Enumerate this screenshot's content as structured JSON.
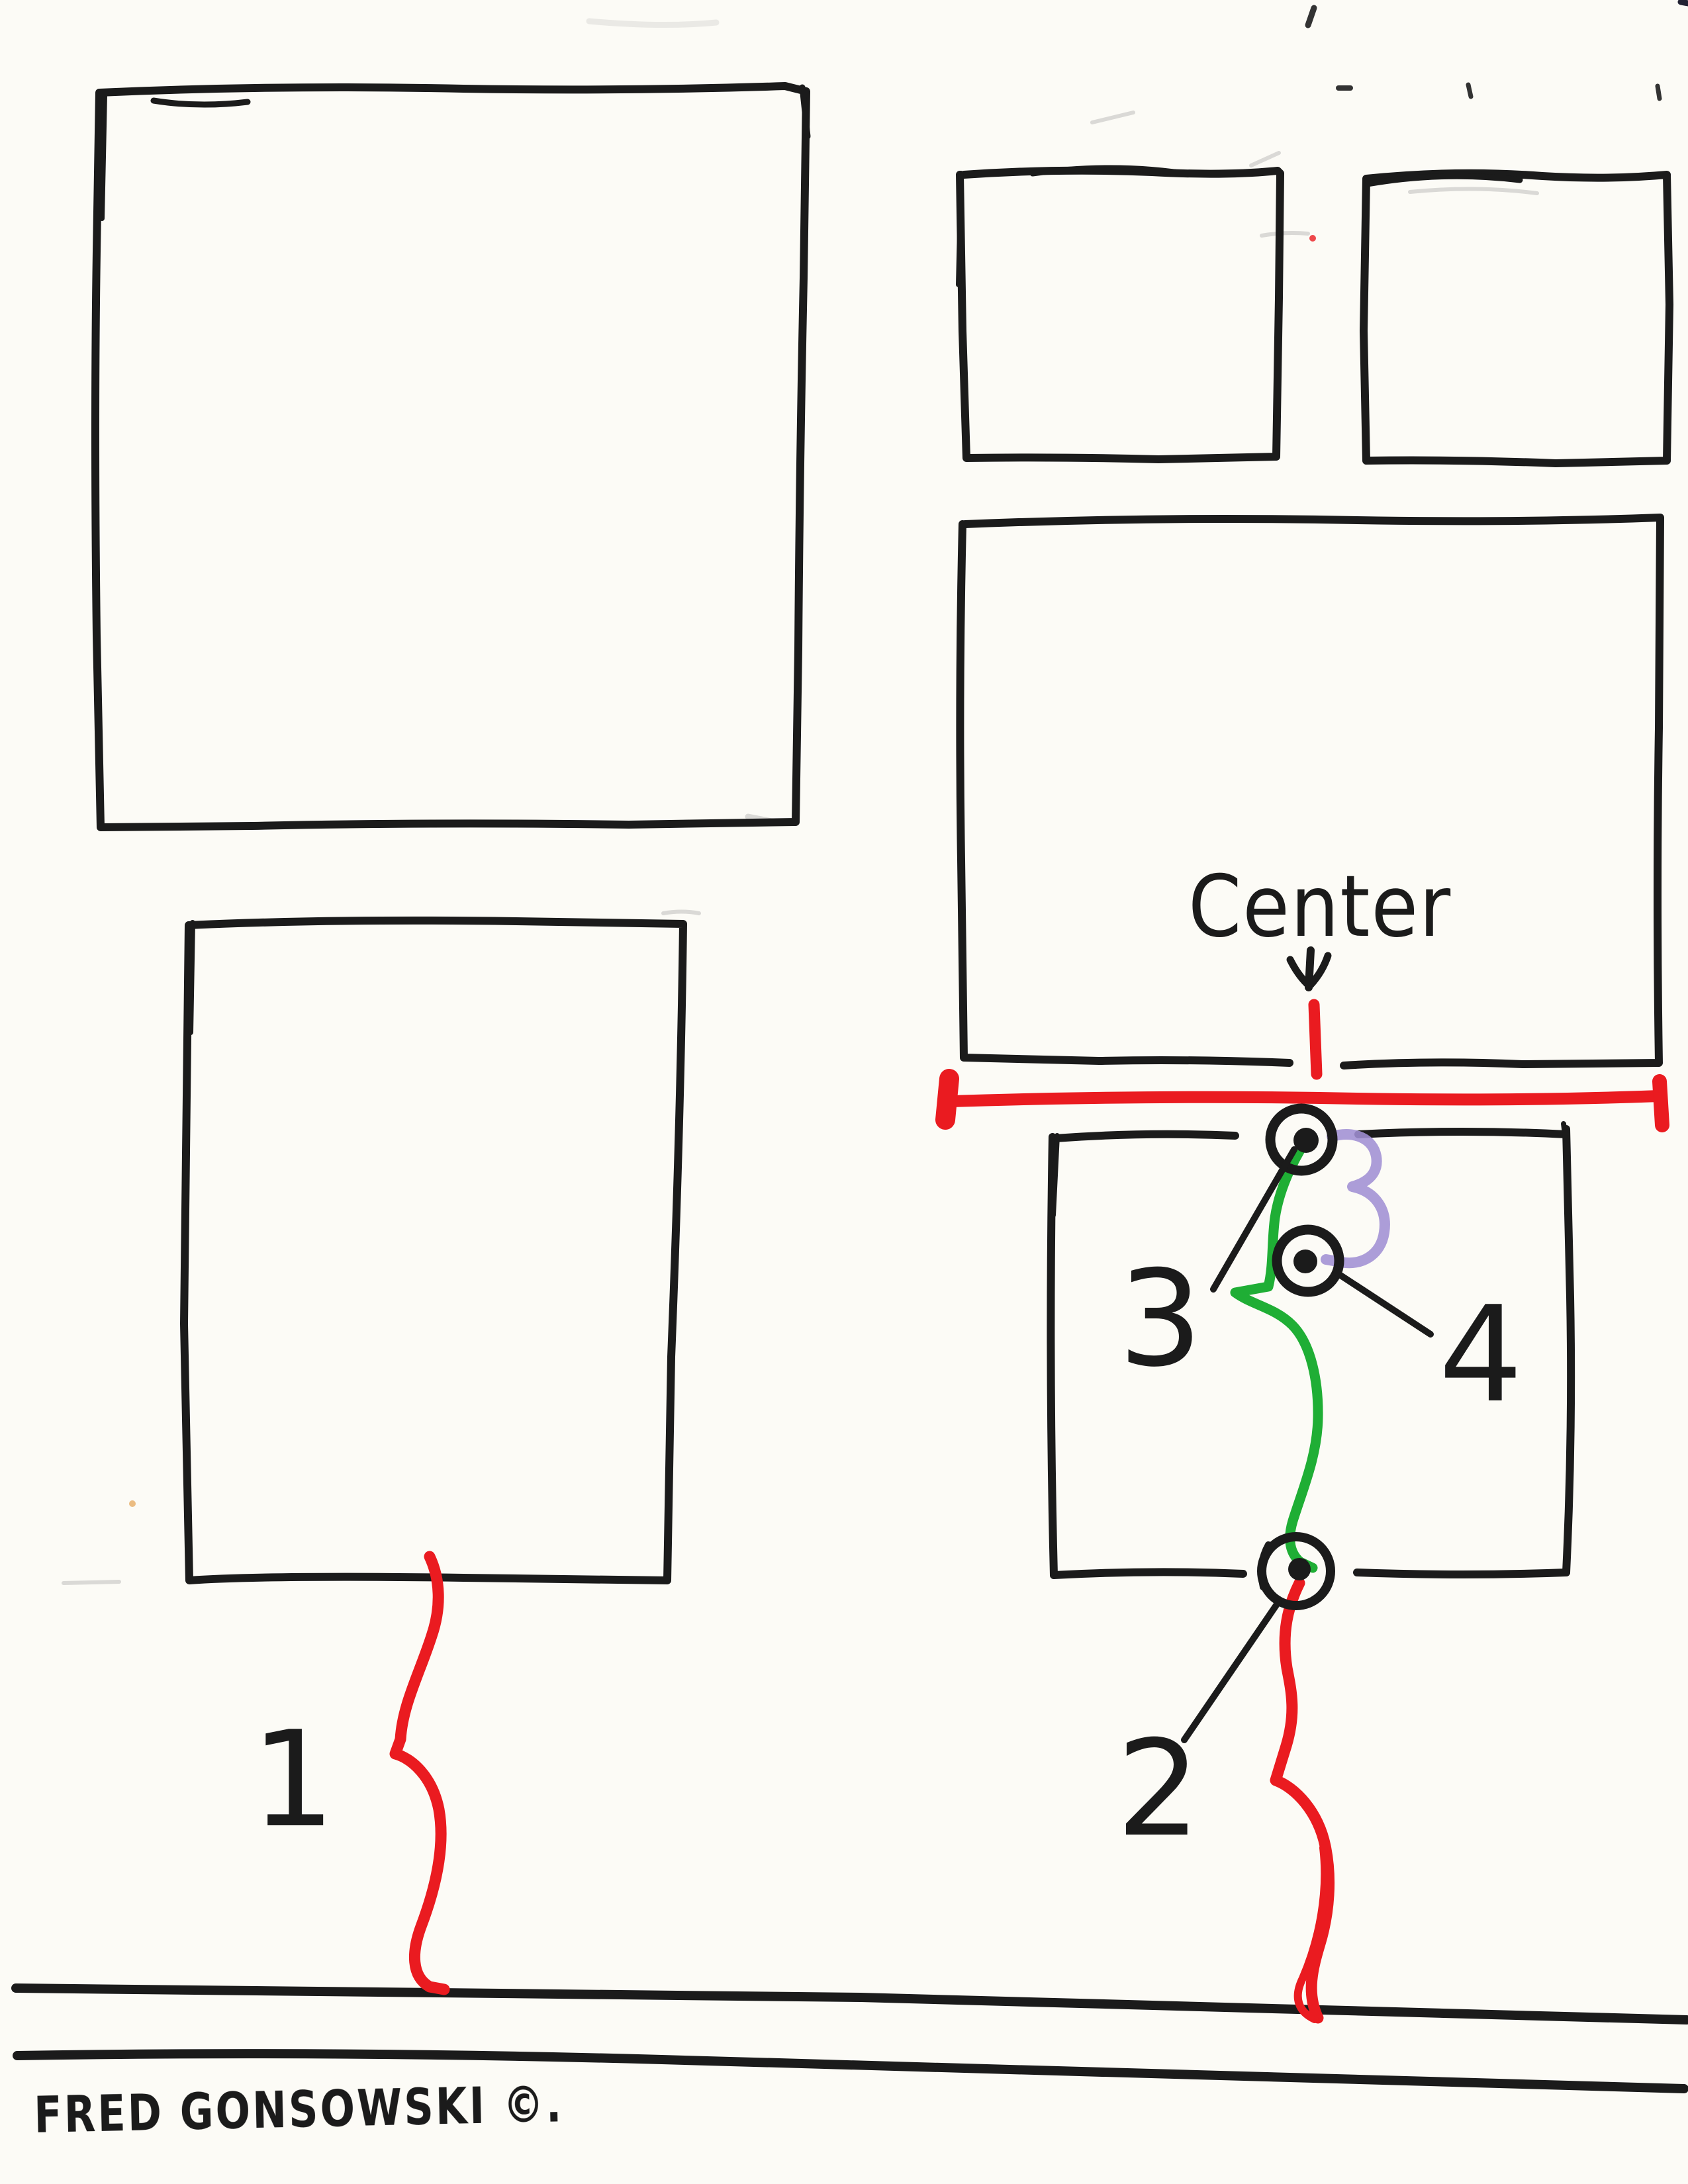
{
  "page": {
    "kind": "hand-drawn picture-hanging diagram, scanned marker sketch",
    "background": "#fcfbf6"
  },
  "colors": {
    "ink": "#1b1b1b",
    "red": "#ea1b20",
    "green": "#1fae35",
    "purple": "#a08fd4",
    "paper": "#fcfbf6",
    "smudge": "#9a9a9a",
    "accent_dot": "#dd8822"
  },
  "labels": {
    "center": "Center",
    "step_1": "1",
    "step_2": "2",
    "step_3": "3",
    "step_4": "4",
    "signature": "FRED GONSOWSKI ©."
  },
  "elements": {
    "frames": [
      "large-square-top-left",
      "medium-square-bottom-left",
      "small-square-top-right-left",
      "small-square-top-right-right",
      "wide-frame-right",
      "lower-frame-right"
    ],
    "nails": [
      "top-nail",
      "middle-nail",
      "bottom-nail"
    ],
    "wires": [
      "green-wire",
      "purple-wire"
    ],
    "measures": [
      "red-width-line",
      "red-center-tick",
      "red-squiggle-1",
      "red-squiggle-2"
    ],
    "floor": [
      "floor-line-upper",
      "floor-line-lower"
    ]
  }
}
